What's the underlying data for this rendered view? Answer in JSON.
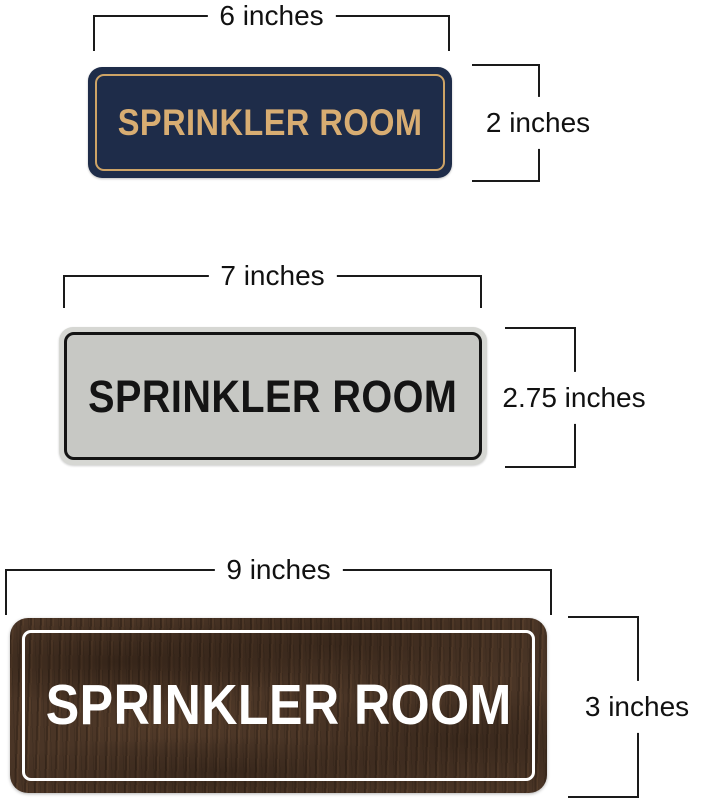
{
  "dimension_color": "#1a1a1a",
  "signs": [
    {
      "variant": "navy-gold",
      "text": "SPRINKLER ROOM",
      "width_label": "6 inches",
      "height_label": "2 inches",
      "colors": {
        "plate": "#1e2c49",
        "border": "#cda366",
        "text": "#d8ad72"
      }
    },
    {
      "variant": "silver-black",
      "text": "SPRINKLER ROOM",
      "width_label": "7 inches",
      "height_label": "2.75 inches",
      "colors": {
        "rim": "#d6d7d3",
        "plate": "#c7c8c4",
        "border": "#141414",
        "text": "#141414"
      }
    },
    {
      "variant": "walnut-white",
      "text": "SPRINKLER ROOM",
      "width_label": "9 inches",
      "height_label": "3 inches",
      "colors": {
        "plate": "#4a3526",
        "border": "#ffffff",
        "text": "#ffffff"
      }
    }
  ]
}
